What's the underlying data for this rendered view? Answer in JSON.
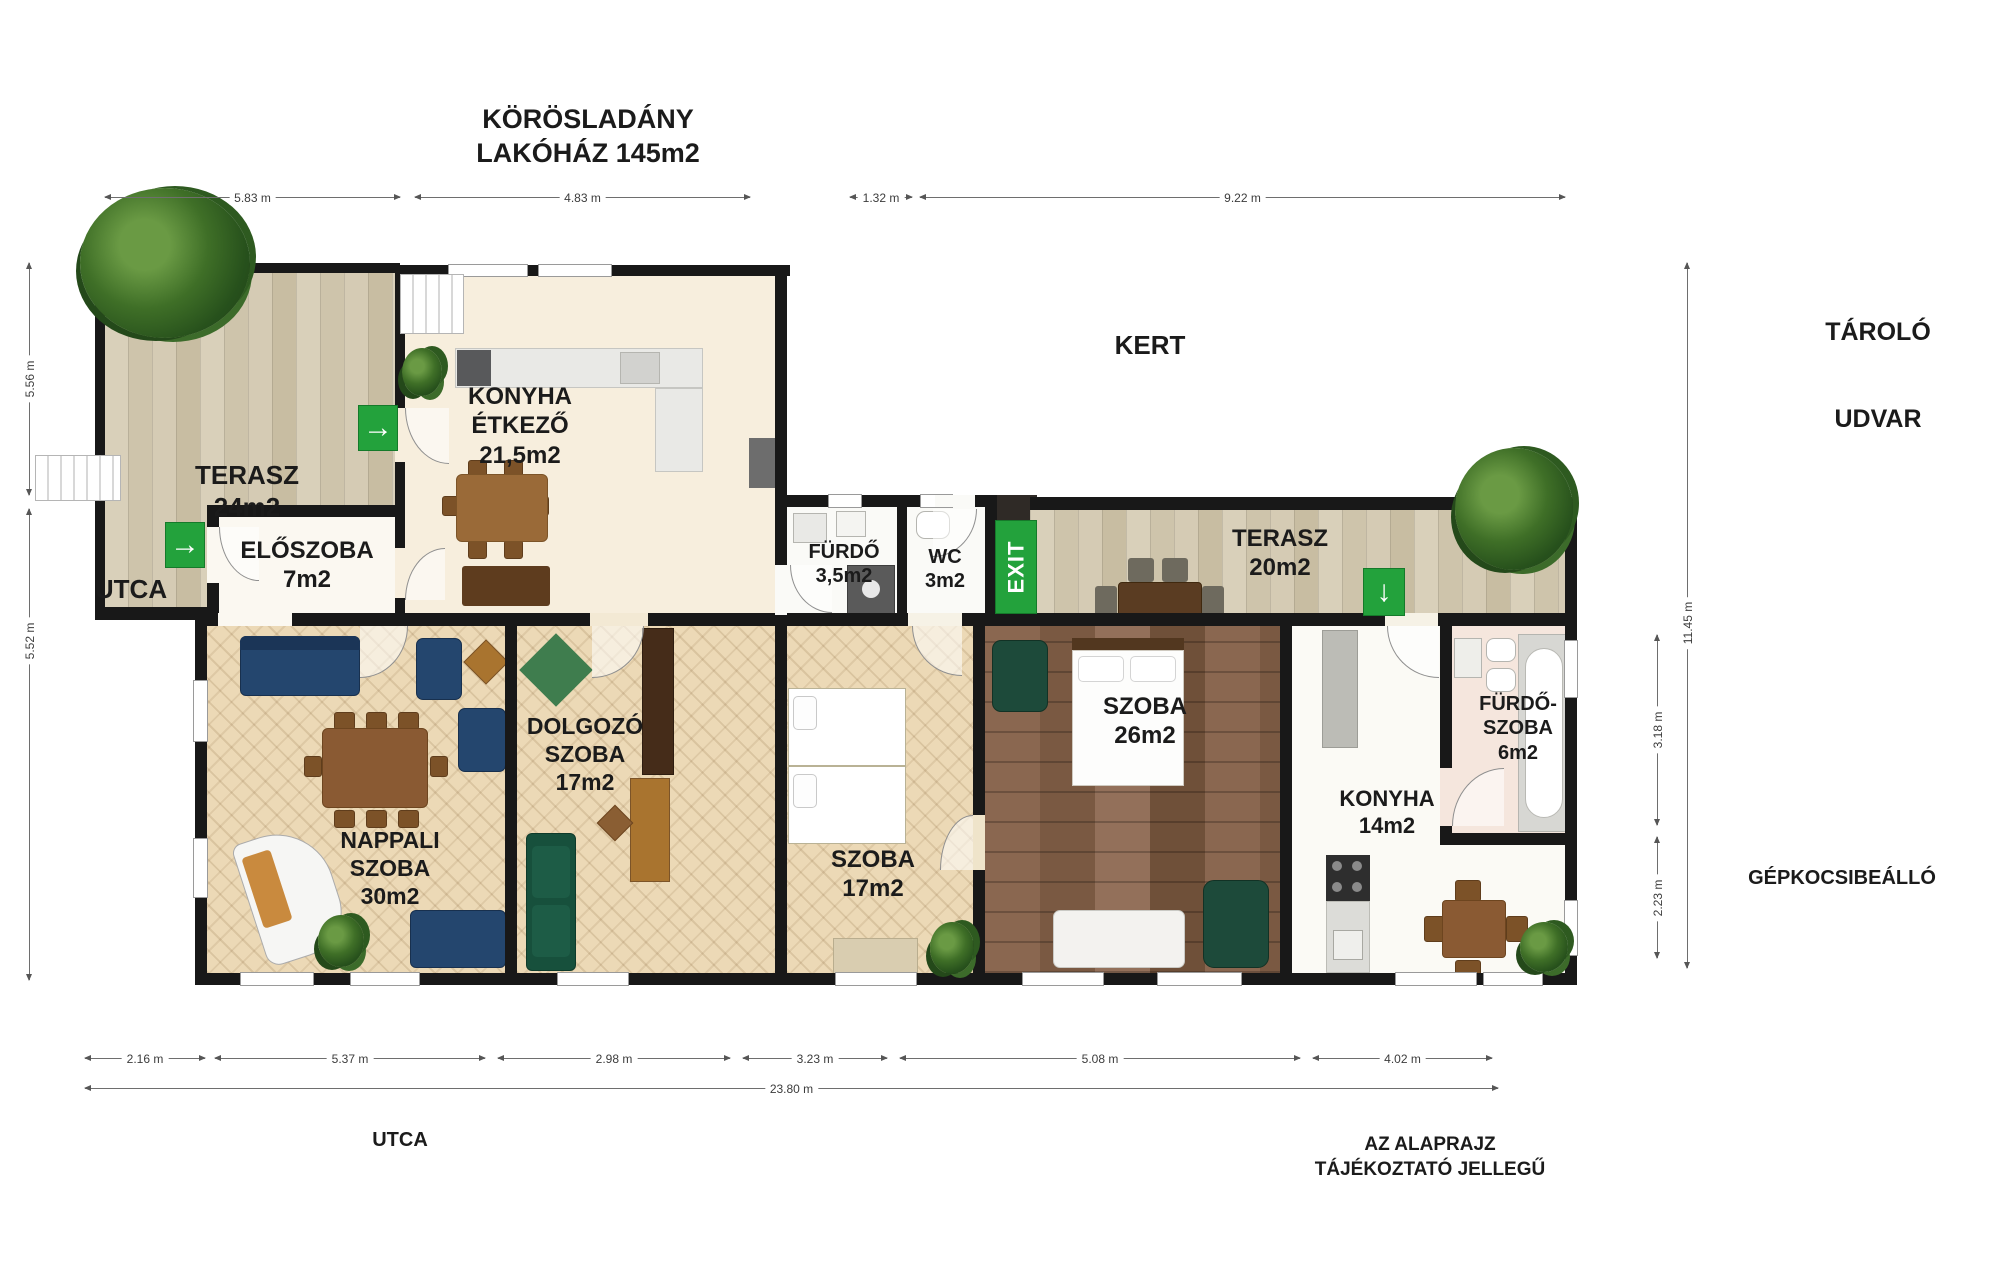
{
  "title": {
    "line1": "KÖRÖSLADÁNY",
    "line2": "LAKÓHÁZ 145m2"
  },
  "rooms": {
    "terasz_left": {
      "name": "TERASZ",
      "area": "24m2"
    },
    "eloszoba": {
      "name": "ELŐSZOBA",
      "area": "7m2"
    },
    "konyha_etkezo": {
      "name": "KONYHA",
      "name2": "ÉTKEZŐ",
      "area": "21,5m2"
    },
    "furdo": {
      "name": "FÜRDŐ",
      "area": "3,5m2"
    },
    "wc": {
      "name": "WC",
      "area": "3m2"
    },
    "terasz_right": {
      "name": "TERASZ",
      "area": "20m2"
    },
    "szoba_26": {
      "name": "SZOBA",
      "area": "26m2"
    },
    "szoba_17": {
      "name": "SZOBA",
      "area": "17m2"
    },
    "dolgozo": {
      "name": "DOLGOZÓ",
      "name2": "SZOBA",
      "area": "17m2"
    },
    "nappali": {
      "name": "NAPPALI",
      "name2": "SZOBA",
      "area": "30m2"
    },
    "konyha_14": {
      "name": "KONYHA",
      "area": "14m2"
    },
    "furdoszoba_6": {
      "name": "FÜRDŐ-",
      "name2": "SZOBA",
      "area": "6m2"
    }
  },
  "outdoor": {
    "kert": "KERT",
    "tarolo": "TÁROLÓ",
    "udvar": "UDVAR",
    "utca_left": "UTCA",
    "utca_bottom": "UTCA",
    "gepkocsibeallo": "GÉPKOCSIBEÁLLÓ",
    "disclaimer_line1": "AZ ALAPRAJZ",
    "disclaimer_line2": "TÁJÉKOZTATÓ JELLEGŰ"
  },
  "dimensions": {
    "top": [
      {
        "label": "5.83 m"
      },
      {
        "label": "4.83 m"
      },
      {
        "label": "1.32 m"
      },
      {
        "label": "9.22 m"
      }
    ],
    "bottom": [
      {
        "label": "2.16 m"
      },
      {
        "label": "5.37 m"
      },
      {
        "label": "2.98 m"
      },
      {
        "label": "3.23 m"
      },
      {
        "label": "5.08 m"
      },
      {
        "label": "4.02 m"
      }
    ],
    "bottom_total": "23.80 m",
    "left": [
      {
        "label": "5.56 m"
      },
      {
        "label": "5.52 m"
      }
    ],
    "right": [
      {
        "label": "11.45 m"
      },
      {
        "label": "3.18 m"
      },
      {
        "label": "2.23 m"
      }
    ]
  },
  "signs": {
    "exit": "EXIT",
    "arrow_right": "→",
    "arrow_down": "↓"
  },
  "colors": {
    "wall": "#181818",
    "exit_green": "#23a23c",
    "terrace_wood": "#d4cab3",
    "dark_wood": "#84624a",
    "parquet": "#ecd9b6",
    "cream_floor": "#f7eedd",
    "pink_floor": "#f5e6dd"
  }
}
